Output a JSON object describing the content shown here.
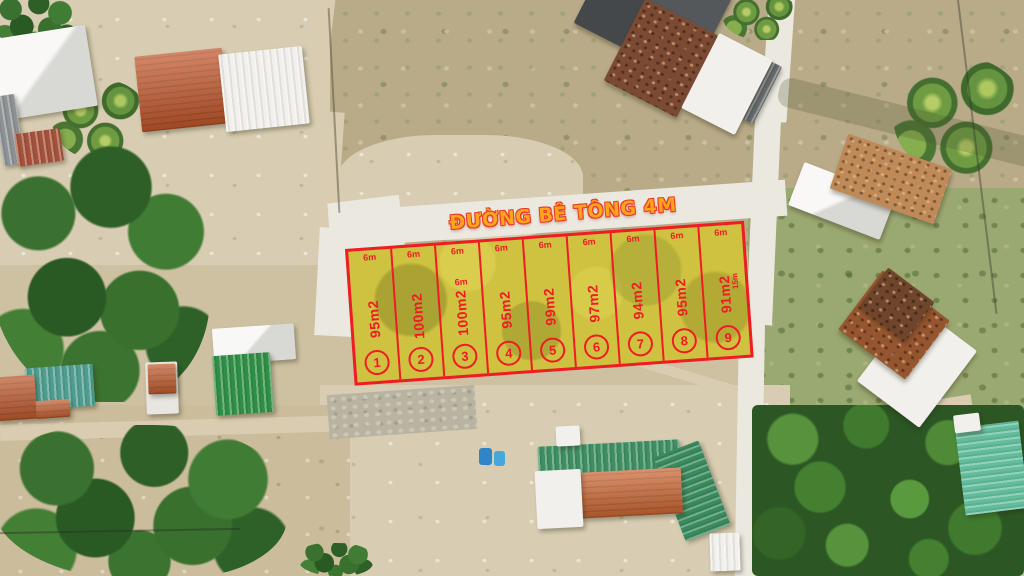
{
  "road": {
    "label": "ĐƯỜNG BÊ TÔNG 4M"
  },
  "plots": [
    {
      "number": "1",
      "area": "95m2",
      "width": "6m"
    },
    {
      "number": "2",
      "area": "100m2",
      "width": "6m"
    },
    {
      "number": "3",
      "area": "100m2",
      "width": "6m"
    },
    {
      "number": "4",
      "area": "95m2",
      "width": "6m"
    },
    {
      "number": "5",
      "area": "99m2",
      "width": "6m"
    },
    {
      "number": "6",
      "area": "97m2",
      "width": "6m"
    },
    {
      "number": "7",
      "area": "94m2",
      "width": "6m"
    },
    {
      "number": "8",
      "area": "95m2",
      "width": "6m"
    },
    {
      "number": "9",
      "area": "91m2",
      "width": "6m"
    }
  ],
  "labels": {
    "extra_width": "6m",
    "depth": "15m"
  },
  "colors": {
    "boundary_red": "#ee1c25",
    "plot_fill_yellow": "#cfc240",
    "road_text_orange": "#ffa41b",
    "road_text_outline": "#e8392a"
  }
}
